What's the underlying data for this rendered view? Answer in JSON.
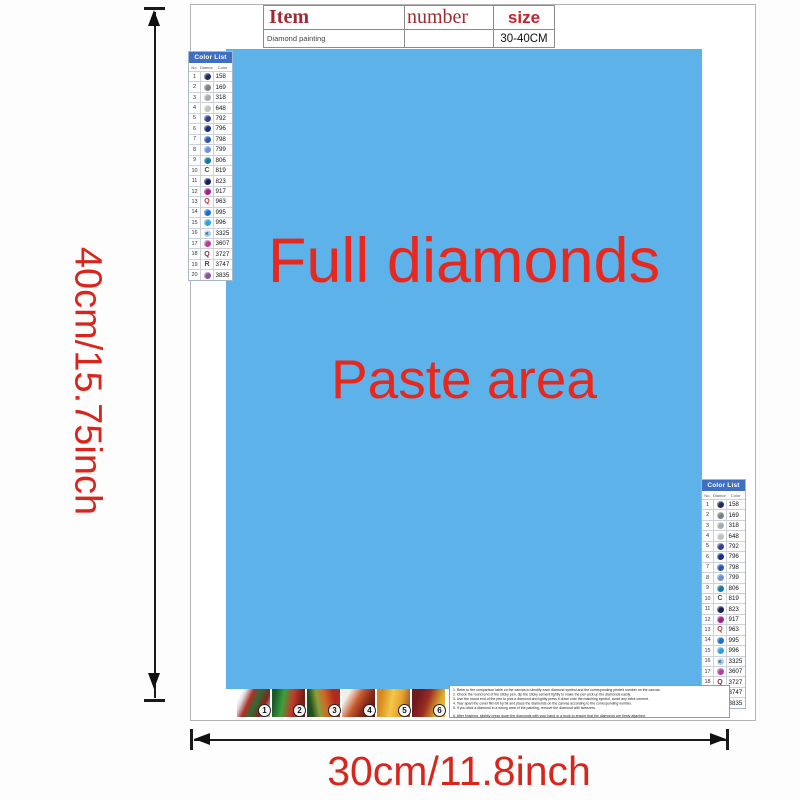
{
  "dimensions": {
    "height_label": "40cm/15.75inch",
    "width_label": "30cm/11.8inch"
  },
  "item_table": {
    "headers": [
      "Item",
      "number",
      "size"
    ],
    "row": [
      "Diamond painting",
      "",
      "30-40CM"
    ]
  },
  "paste_area": {
    "line1": "Full diamonds",
    "line2": "Paste area",
    "background_color": "#5cb2e9",
    "text_color": "#e8271d"
  },
  "color_list": {
    "title": "Color List",
    "columns": [
      "No.",
      "Diamond",
      "Color"
    ],
    "rows": [
      {
        "no": "1",
        "type": "circle",
        "char": "",
        "color": "#1d2b5f",
        "code": "158"
      },
      {
        "no": "2",
        "type": "circle",
        "char": "",
        "color": "#7d7f82",
        "code": "169"
      },
      {
        "no": "3",
        "type": "circle",
        "char": "",
        "color": "#a7abae",
        "code": "318"
      },
      {
        "no": "4",
        "type": "circle",
        "char": "",
        "color": "#c0c3b8",
        "code": "648"
      },
      {
        "no": "5",
        "type": "circle",
        "char": "",
        "color": "#32408f",
        "code": "792"
      },
      {
        "no": "6",
        "type": "circle",
        "char": "",
        "color": "#162a80",
        "code": "796"
      },
      {
        "no": "7",
        "type": "circle",
        "char": "",
        "color": "#2b55b4",
        "code": "798"
      },
      {
        "no": "8",
        "type": "circle",
        "char": "",
        "color": "#7090d5",
        "code": "799"
      },
      {
        "no": "9",
        "type": "circle",
        "char": "",
        "color": "#1377a4",
        "code": "806"
      },
      {
        "no": "10",
        "type": "letter",
        "char": "C",
        "color": "#4a4a4a",
        "code": "819"
      },
      {
        "no": "11",
        "type": "circle",
        "char": "",
        "color": "#141f57",
        "code": "823"
      },
      {
        "no": "12",
        "type": "circle",
        "char": "",
        "color": "#a21e8e",
        "code": "917"
      },
      {
        "no": "13",
        "type": "letter",
        "char": "Q",
        "color": "#b23a3a",
        "code": "963"
      },
      {
        "no": "14",
        "type": "circle",
        "char": "",
        "color": "#1b6fd1",
        "code": "995"
      },
      {
        "no": "15",
        "type": "circle",
        "char": "",
        "color": "#2ba3e0",
        "code": "996"
      },
      {
        "no": "16",
        "type": "circle",
        "char": "K",
        "charColor": "#1c3e7e",
        "color": "#a9cbec",
        "code": "3325"
      },
      {
        "no": "17",
        "type": "circle",
        "char": "",
        "color": "#b43da0",
        "code": "3607"
      },
      {
        "no": "18",
        "type": "letter",
        "char": "Q",
        "color": "#8e2446",
        "code": "3727"
      },
      {
        "no": "19",
        "type": "letter",
        "char": "R",
        "color": "#4a4a4a",
        "code": "3747"
      },
      {
        "no": "20",
        "type": "circle",
        "char": "",
        "color": "#82549b",
        "code": "3835"
      }
    ]
  },
  "steps": [
    "1",
    "2",
    "3",
    "4",
    "5",
    "6"
  ],
  "instructions": [
    "1. Refer to the comparison table on the canvas to identify each diamond symbol and the corresponding printed number on the canvas.",
    "2. Check the round end of the sticky pen, dip the sticky cement lightly to make the pen pick up the diamonds easily.",
    "3. Use the round end of the pen to pick a diamond and lightly press it down onto the matching symbol, avoid any extra cement.",
    "4. Tear apart the cover film bit by bit and place the diamonds on the canvas according to the corresponding number.",
    "5. If you stick a diamond in a wrong area of the painting, remove the diamond with tweezers.",
    "6. After finishing, slightly press down the diamonds with your hand or a book to ensure that the diamonds are firmly attached."
  ]
}
